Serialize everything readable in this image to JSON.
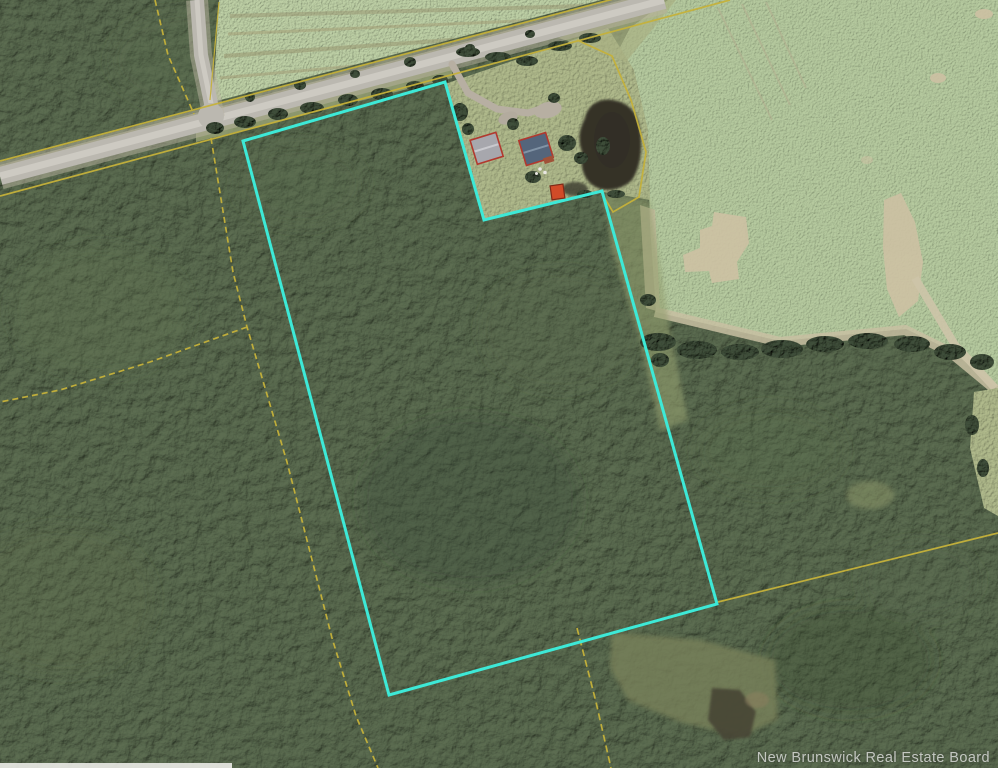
{
  "watermark": {
    "text": "New Brunswick Real Estate Board",
    "color": "#FFFFFF"
  },
  "map": {
    "type": "aerial-property-photo",
    "highlight_boundary": {
      "color": "#3DE9D7",
      "points": "243,141 445,82 484,220 602,191 717,604 389,695"
    },
    "parcel_lines": {
      "color": "#C6B23A",
      "road_north_line": "0,161 655,-12",
      "road_south_line": "0,196 730,0",
      "side_road_west_line": "155,0 168,55 194,114",
      "field_west_line": "219,2 210,100",
      "interior_line": "211,138 233,272 247,327 287,462 332,638 356,716 378,768",
      "west_branch_line": "247,327 150,362 60,390 0,402",
      "house_lot_line": "577,40 612,56 631,100 646,152 639,197 613,212 601,192",
      "southeast_line": "718,602 998,533",
      "south_line": "577,628 596,702 611,768"
    },
    "roads": {
      "surface_color": "#bbb8b0",
      "center_color": "#cdcac2",
      "shoulder_color": "#b9b39f",
      "main_road_path": "0,176 664,0",
      "side_road_path": "197,0 201,55 214,118",
      "driveway_path": "452,64 468,93 497,109 528,113 550,106"
    },
    "terrain": {
      "forest_color": "#4e5c44",
      "field_color": "#a5b98f",
      "lawn_color": "#a2ab7c",
      "dirt_color": "#c8bfa2",
      "clearing_color": "#a8bb94",
      "marsh_light_color": "#79815a",
      "marsh_dark_color": "#474434",
      "edge_strip_color": "#ecece8"
    },
    "pond": {
      "color": "#343228"
    },
    "buildings": {
      "house": {
        "roof_color": "#54657b",
        "ridge_color": "#8193a6",
        "trim_color": "#b2392e",
        "deck_color": "#a05238"
      },
      "garage": {
        "roof_color": "#a7a7ad",
        "ridge_color": "#c9c9ce",
        "trim_color": "#b2392e"
      },
      "shed": {
        "color": "#d14b28",
        "trim_color": "#7e2a18"
      }
    }
  }
}
